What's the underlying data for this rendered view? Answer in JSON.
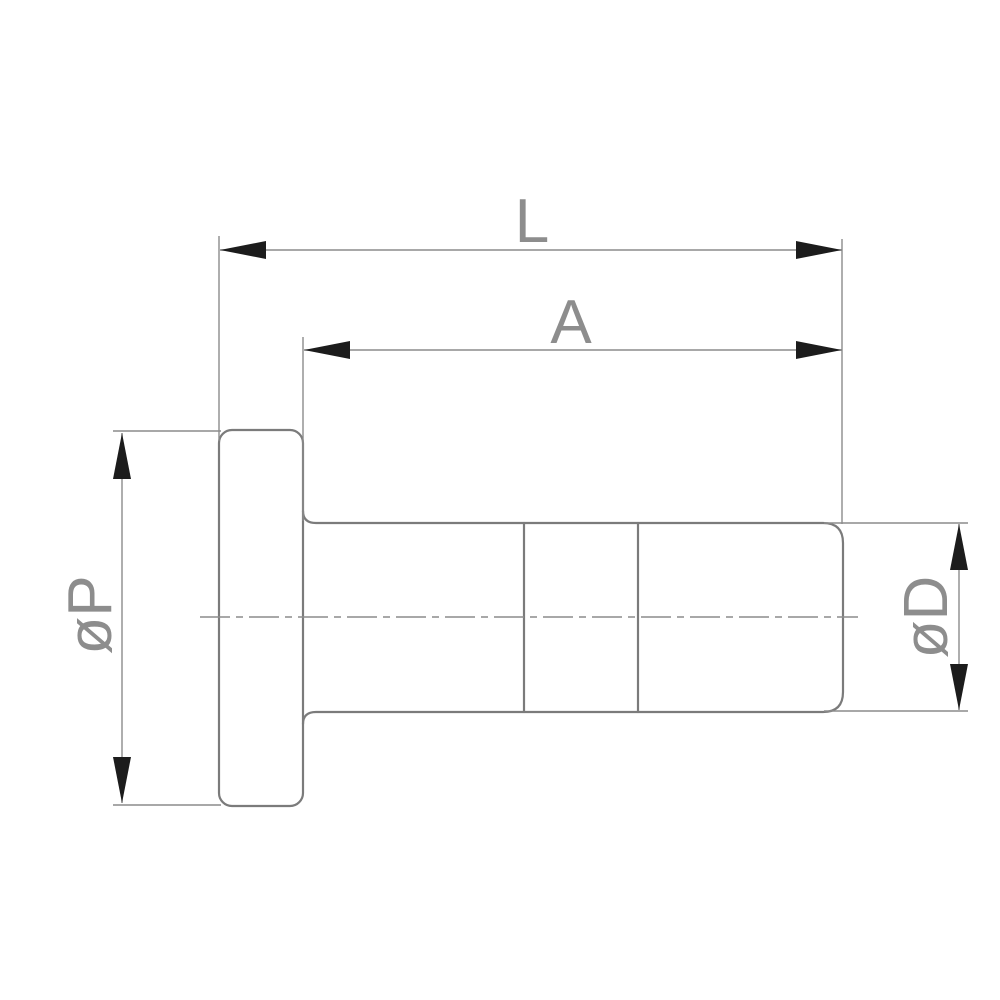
{
  "labels": {
    "dim_overall_length": "L",
    "dim_body_length": "A",
    "dim_flange_diameter": "øP",
    "dim_body_diameter": "øD"
  },
  "colors": {
    "background": "#ffffff",
    "outline": "#7b7b7b",
    "dimline": "#8c8c8c",
    "arrow": "#1c1c1c",
    "text": "#8d8d8d"
  }
}
